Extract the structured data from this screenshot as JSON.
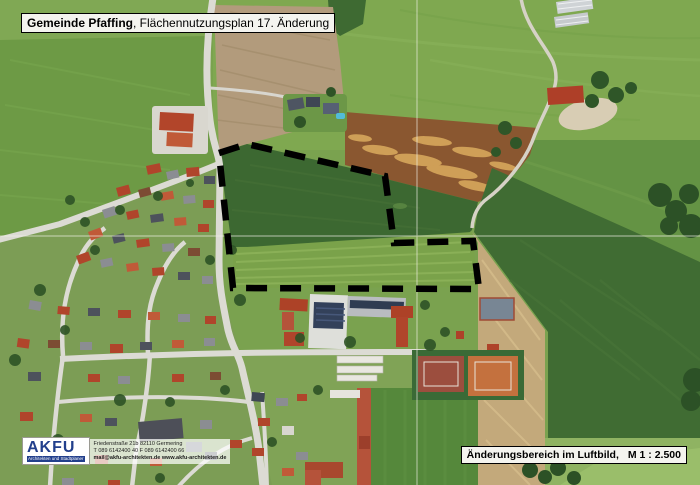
{
  "header": {
    "municipality": "Gemeinde Pfaffing",
    "plan_title": ", Flächennutzungsplan 17. Änderung"
  },
  "scale_box": {
    "area_label": "Änderungsbereich im Luftbild,",
    "scale": "M 1 : 2.500"
  },
  "logo": {
    "name": "AKFU",
    "tagline": "Architekten und Stadtplaner",
    "address": "Friedenstraße 21b  82110 Germering",
    "contact": "T 089 6142400 40   F 089 6142400 66",
    "web": "mail@akfu-architekten.de   www.akfu-architekten.de"
  },
  "map": {
    "boundary": {
      "points": "219,153 247,144 385,176 394,243 473,241 479,289 233,288",
      "color": "#000000",
      "style": "dashed"
    },
    "grid": {
      "v_path": "M417,0 L417,485",
      "h_path": "M0,236 L700,236",
      "color": "#f2f1e8"
    },
    "colors": {
      "boundary": "#000000",
      "meadow": "#6f9b47",
      "corn_field": "#3d6931",
      "tilled_field": "#b29b7c",
      "rust_field": "#8a5730",
      "stubble_field": "#c3a97b",
      "roof_red": "#b0452b",
      "tennis_orange": "#c4713e",
      "logo_blue": "#223f8c"
    }
  }
}
